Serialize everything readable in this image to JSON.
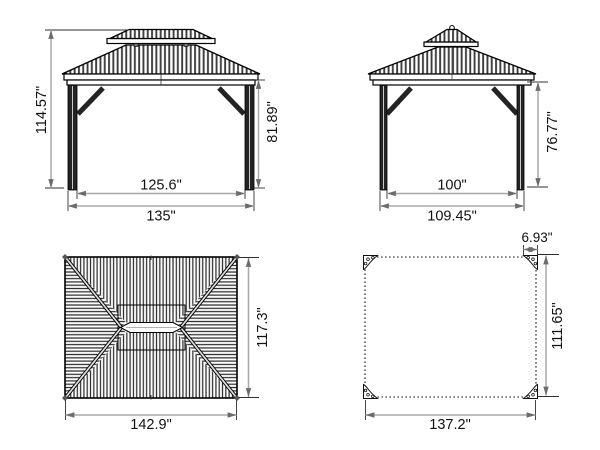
{
  "drawing": {
    "unit_suffix": "\"",
    "views": {
      "front_elevation": {
        "dims": {
          "total_height": "114.57\"",
          "eave_height": "81.89\"",
          "inner_width": "125.6\"",
          "outer_width": "135\""
        }
      },
      "side_elevation": {
        "dims": {
          "eave_height": "76.77\"",
          "inner_width": "100\"",
          "outer_width": "109.45\""
        }
      },
      "roof_plan": {
        "dims": {
          "depth": "117.3\"",
          "width": "142.9\""
        }
      },
      "footprint_plan": {
        "dims": {
          "base_plate_width": "6.93\"",
          "depth": "111.65\"",
          "width": "137.2\""
        }
      }
    },
    "colors": {
      "geometry_line": "#000000",
      "dimension_line": "#a8a8a8",
      "text": "#111111",
      "background": "#ffffff"
    }
  }
}
